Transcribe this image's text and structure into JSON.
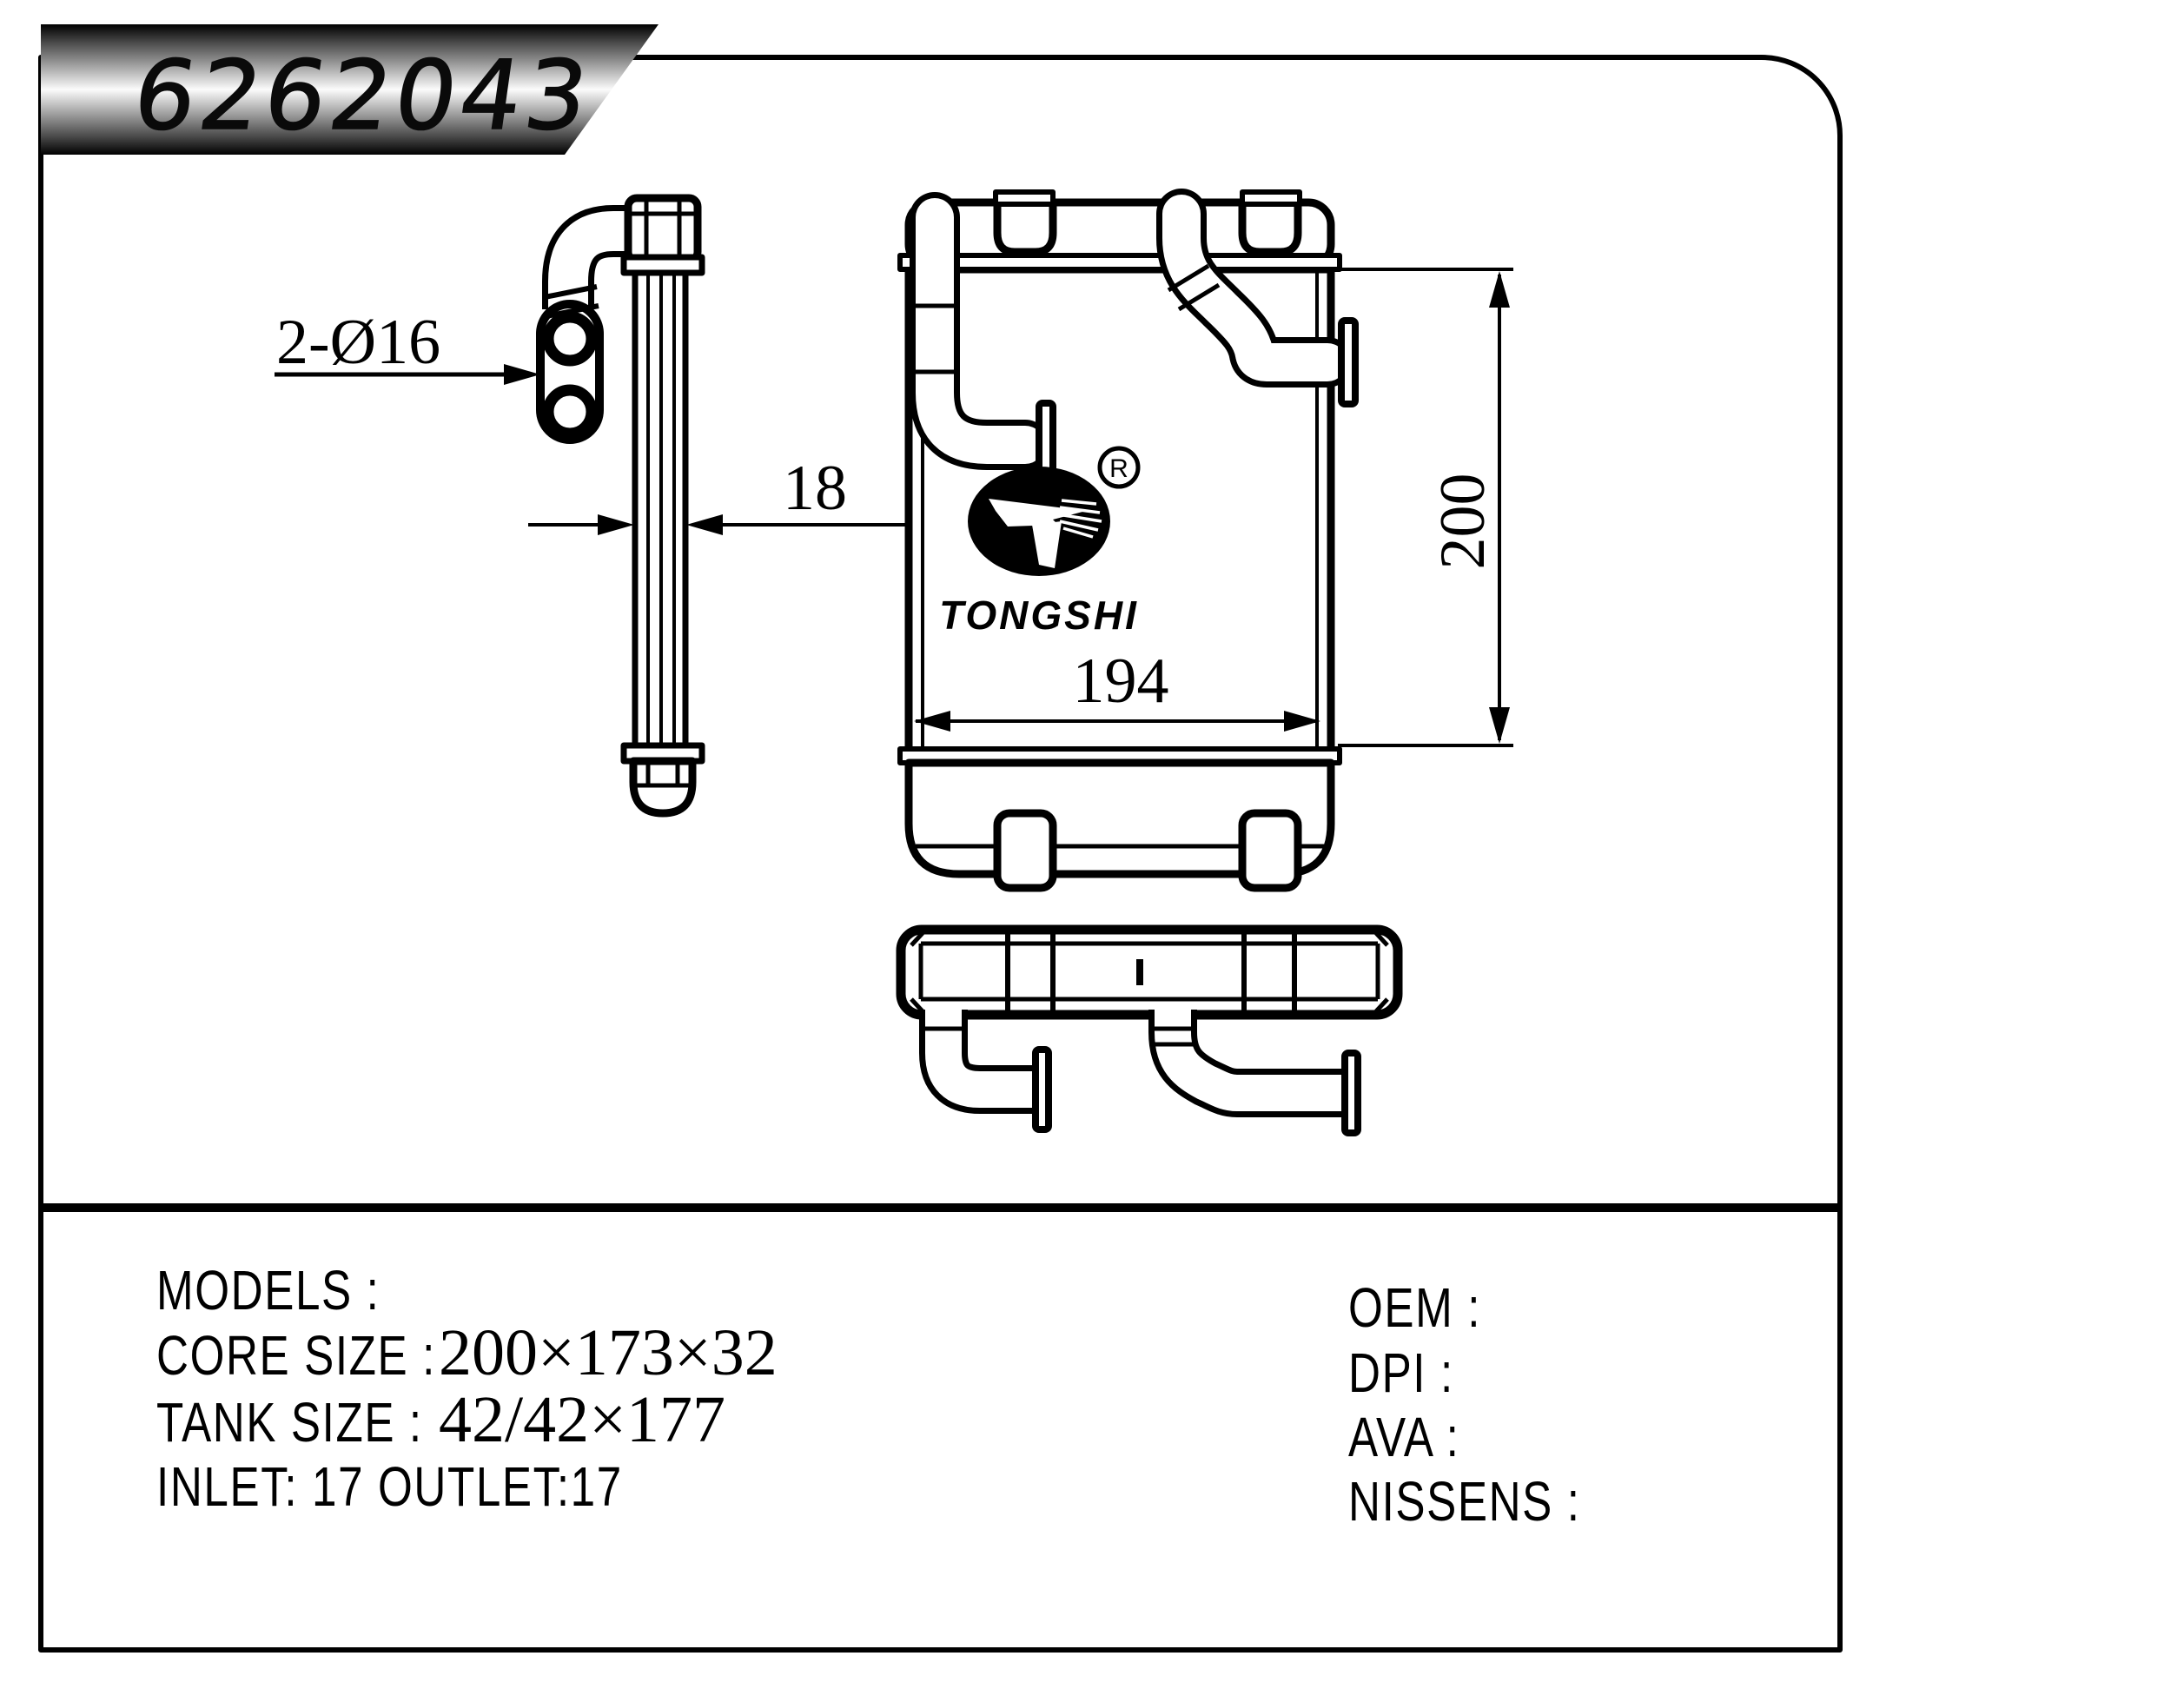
{
  "banner": {
    "part_number": "6262043"
  },
  "drawing": {
    "logo": {
      "brand": "TONGSHI",
      "registered": "R"
    },
    "dimensions": {
      "ports": "2-Ø16",
      "thickness": "18",
      "width": "194",
      "height": "200"
    }
  },
  "specs": {
    "left_rows": [
      {
        "label": "MODELS :",
        "value": ""
      },
      {
        "label": "CORE SIZE :",
        "value": "200×173×32"
      },
      {
        "label": "TANK SIZE :",
        "value": "42/42×177"
      },
      {
        "label": "INLET: 17  OUTLET:17",
        "value": ""
      }
    ],
    "right_rows": [
      {
        "label": "OEM  :"
      },
      {
        "label": "DPI  :"
      },
      {
        "label": "AVA  :"
      },
      {
        "label": "NISSENS :"
      }
    ]
  },
  "colors": {
    "ink": "#000000",
    "paper": "#ffffff"
  }
}
